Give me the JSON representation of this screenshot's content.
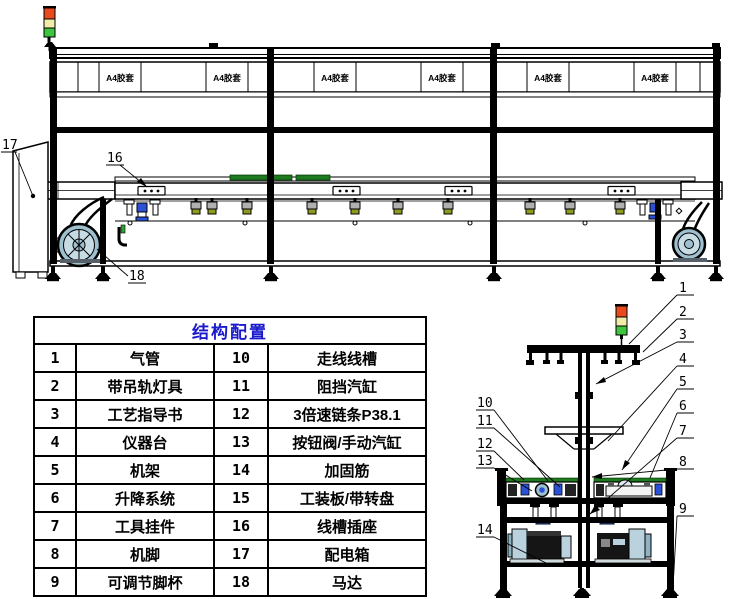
{
  "parts_table": {
    "header": "结构配置",
    "rows": [
      {
        "no_left": "1",
        "name_left": "气管",
        "no_right": "10",
        "name_right": "走线线槽"
      },
      {
        "no_left": "2",
        "name_left": "带吊轨灯具",
        "no_right": "11",
        "name_right": "阻挡汽缸"
      },
      {
        "no_left": "3",
        "name_left": "工艺指导书",
        "no_right": "12",
        "name_right": "3倍速链条P38.1"
      },
      {
        "no_left": "4",
        "name_left": "仪器台",
        "no_right": "13",
        "name_right": "按钮阀/手动汽缸"
      },
      {
        "no_left": "5",
        "name_left": "机架",
        "no_right": "14",
        "name_right": "加固筋"
      },
      {
        "no_left": "6",
        "name_left": "升降系统",
        "no_right": "15",
        "name_right": "工装板/带转盘"
      },
      {
        "no_left": "7",
        "name_left": "工具挂件",
        "no_right": "16",
        "name_right": "线槽插座"
      },
      {
        "no_left": "8",
        "name_left": "机脚",
        "no_right": "17",
        "name_right": "配电箱"
      },
      {
        "no_left": "9",
        "name_left": "可调节脚杯",
        "no_right": "18",
        "name_right": "马达"
      }
    ]
  },
  "main_view": {
    "panel_label": "A4胶套",
    "callouts": {
      "c16": "16",
      "c17": "17",
      "c18": "18"
    }
  },
  "side_view": {
    "callouts_right": [
      "1",
      "2",
      "3",
      "4",
      "5",
      "6",
      "7",
      "8",
      "9"
    ],
    "callouts_left": [
      "10",
      "11",
      "12",
      "13",
      "14"
    ]
  },
  "colors": {
    "table_header_blue": "#1a1acd",
    "lamp_red": "#e8491d",
    "lamp_yellow": "#f1eda8",
    "lamp_green": "#3ec43e",
    "motor_blue": "#9fc0cf",
    "pallet_green": "#1e7a1e",
    "cylinder_blue": "#2b52d6",
    "valve_olive": "#8e9c1e"
  }
}
